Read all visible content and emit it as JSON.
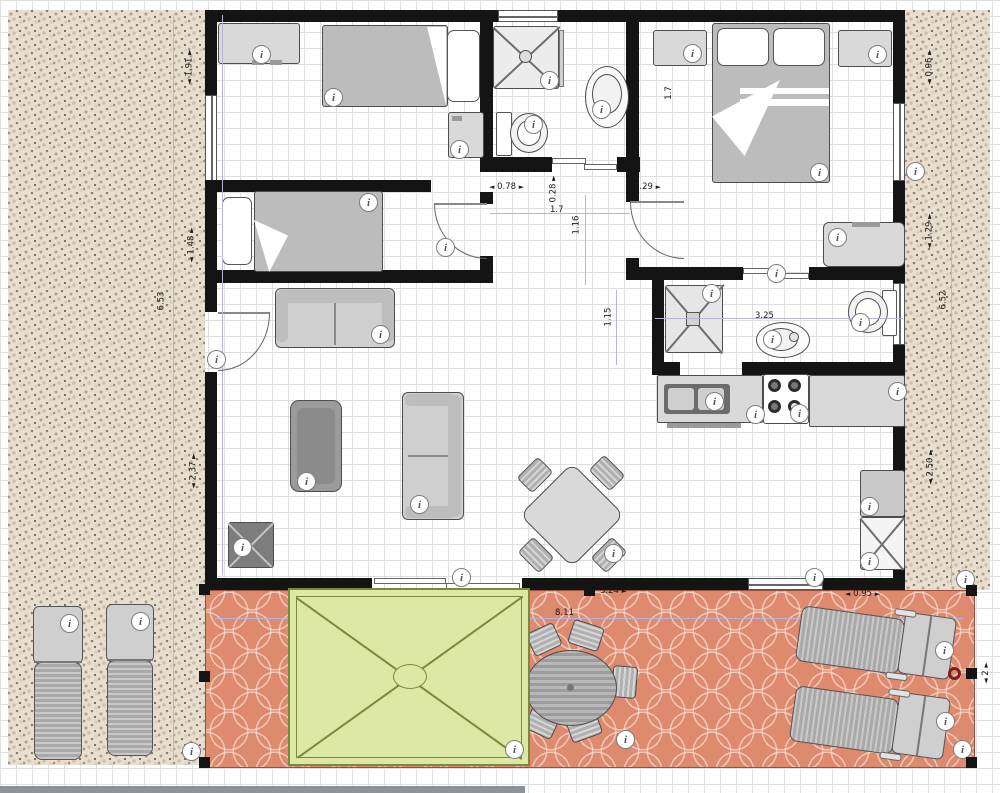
{
  "glyphs": {
    "arrow_left": "◄",
    "arrow_right": "►",
    "arrow_up": "▲",
    "arrow_down": "▼",
    "info": "i"
  },
  "dimensions": {
    "hall_door_width": "0.78",
    "hall_nook_depth": "0.28",
    "hall_right_offset": "0.29",
    "hall_width": "1.7",
    "hall_depth": "1.16",
    "bath2_entry": "1.15",
    "master_side": "1.7",
    "bath2_width": "3.25",
    "patio_top_offset": "3.24",
    "patio_width": "8.11",
    "patio_right_offset": "0.95",
    "patio_right_height": "2",
    "left_outer_top": "1.91",
    "left_outer_mid": "1.48",
    "left_outer_wall": "6.53",
    "left_outer_lower": "2.37",
    "right_outer_top": "0.96",
    "right_outer_mid": "1.29",
    "right_outer_wall": "6.52",
    "right_outer_lower": "2.50"
  },
  "colors": {
    "wall": "#141414",
    "furniture": "#bcbcbc",
    "gravel": "#e7decf",
    "patio_tile": "#dd8a6f",
    "gazebo": "#dce8a4",
    "gazebo_border": "#7a8a3c",
    "guide_line": "#b9b2dd",
    "selection_handle": "#141414",
    "rotation_handle": "#7e1d1d"
  }
}
